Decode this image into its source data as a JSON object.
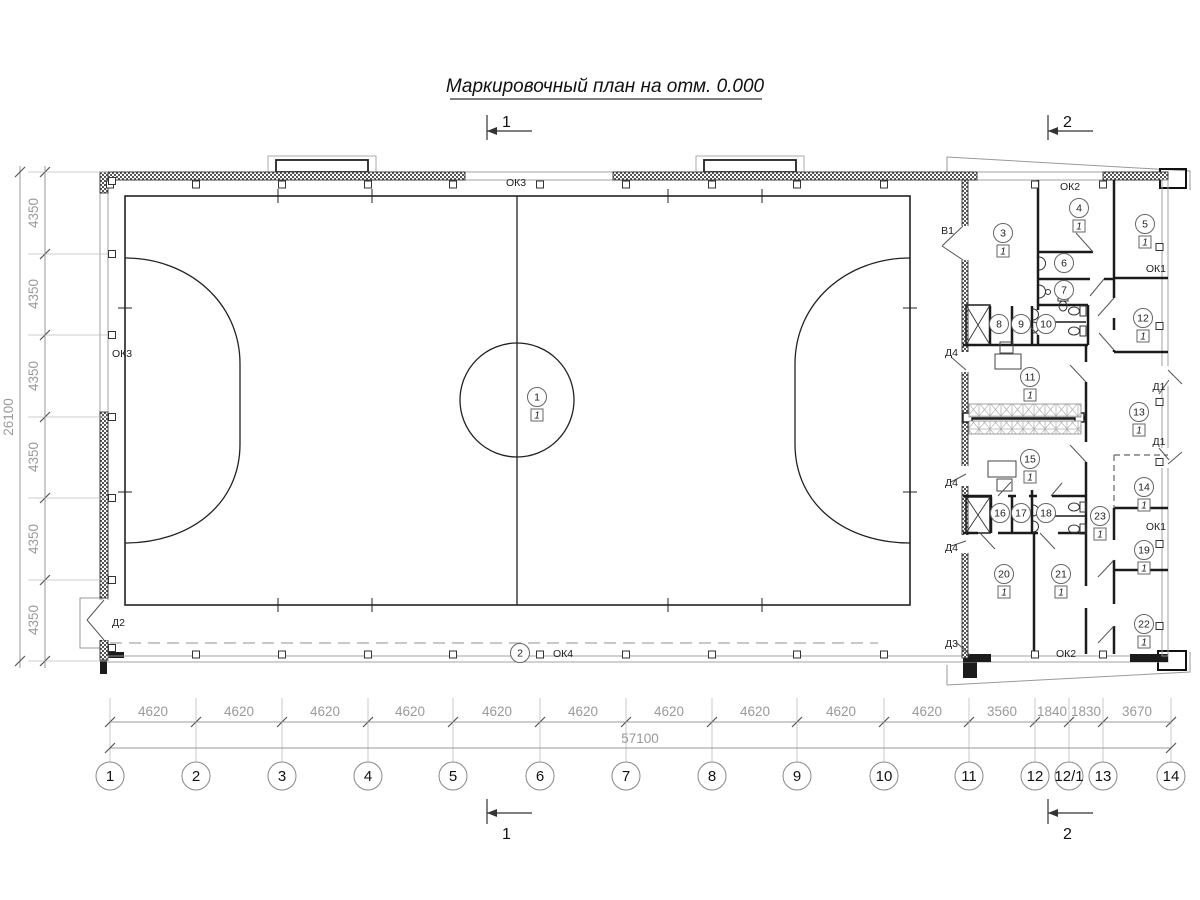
{
  "title": "Маркировочный план на отм. 0.000",
  "section_markers": [
    {
      "label": "1",
      "pos": "top-left"
    },
    {
      "label": "2",
      "pos": "top-right"
    },
    {
      "label": "1",
      "pos": "bottom-left"
    },
    {
      "label": "2",
      "pos": "bottom-right"
    }
  ],
  "grid": {
    "axes": [
      {
        "label": "1",
        "x": 110
      },
      {
        "label": "2",
        "x": 196
      },
      {
        "label": "3",
        "x": 282
      },
      {
        "label": "4",
        "x": 368
      },
      {
        "label": "5",
        "x": 453
      },
      {
        "label": "6",
        "x": 540
      },
      {
        "label": "7",
        "x": 626
      },
      {
        "label": "8",
        "x": 712
      },
      {
        "label": "9",
        "x": 797
      },
      {
        "label": "10",
        "x": 884
      },
      {
        "label": "11",
        "x": 969
      },
      {
        "label": "12",
        "x": 1035
      },
      {
        "label": "12/1",
        "x": 1069
      },
      {
        "label": "13",
        "x": 1103
      },
      {
        "label": "14",
        "x": 1171
      }
    ],
    "dim_segments": [
      {
        "label": "4620",
        "x": 153
      },
      {
        "label": "4620",
        "x": 239
      },
      {
        "label": "4620",
        "x": 325
      },
      {
        "label": "4620",
        "x": 410
      },
      {
        "label": "4620",
        "x": 497
      },
      {
        "label": "4620",
        "x": 583
      },
      {
        "label": "4620",
        "x": 669
      },
      {
        "label": "4620",
        "x": 755
      },
      {
        "label": "4620",
        "x": 841
      },
      {
        "label": "4620",
        "x": 927
      },
      {
        "label": "3560",
        "x": 1002
      },
      {
        "label": "1840",
        "x": 1052
      },
      {
        "label": "1830",
        "x": 1086
      },
      {
        "label": "3670",
        "x": 1137
      }
    ],
    "dim_total": "57100",
    "left_segments": [
      {
        "label": "4350",
        "y": 213
      },
      {
        "label": "4350",
        "y": 294
      },
      {
        "label": "4350",
        "y": 376
      },
      {
        "label": "4350",
        "y": 457
      },
      {
        "label": "4350",
        "y": 539
      },
      {
        "label": "4350",
        "y": 620
      }
    ],
    "left_total": "26100"
  },
  "finish_tag": "1",
  "rooms": [
    {
      "n": "1",
      "x": 537,
      "y": 397,
      "f": true
    },
    {
      "n": "2",
      "x": 520,
      "y": 653,
      "f": false
    },
    {
      "n": "3",
      "x": 1003,
      "y": 233,
      "f": true
    },
    {
      "n": "4",
      "x": 1079,
      "y": 208,
      "f": true
    },
    {
      "n": "5",
      "x": 1145,
      "y": 224,
      "f": true
    },
    {
      "n": "6",
      "x": 1064,
      "y": 263,
      "f": false
    },
    {
      "n": "7",
      "x": 1064,
      "y": 290,
      "f": false
    },
    {
      "n": "8",
      "x": 999,
      "y": 324,
      "f": false
    },
    {
      "n": "9",
      "x": 1021,
      "y": 324,
      "f": false
    },
    {
      "n": "10",
      "x": 1046,
      "y": 324,
      "f": false
    },
    {
      "n": "11",
      "x": 1030,
      "y": 377,
      "f": true
    },
    {
      "n": "12",
      "x": 1143,
      "y": 318,
      "f": true
    },
    {
      "n": "13",
      "x": 1139,
      "y": 412,
      "f": true
    },
    {
      "n": "14",
      "x": 1144,
      "y": 487,
      "f": true
    },
    {
      "n": "15",
      "x": 1030,
      "y": 459,
      "f": true
    },
    {
      "n": "16",
      "x": 1000,
      "y": 513,
      "f": false
    },
    {
      "n": "17",
      "x": 1021,
      "y": 513,
      "f": false
    },
    {
      "n": "18",
      "x": 1046,
      "y": 513,
      "f": false
    },
    {
      "n": "19",
      "x": 1144,
      "y": 550,
      "f": true
    },
    {
      "n": "20",
      "x": 1004,
      "y": 574,
      "f": true
    },
    {
      "n": "21",
      "x": 1061,
      "y": 574,
      "f": true
    },
    {
      "n": "22",
      "x": 1144,
      "y": 624,
      "f": true
    },
    {
      "n": "23",
      "x": 1100,
      "y": 516,
      "f": true
    }
  ],
  "opening_labels": [
    {
      "text": "ОК3",
      "x": 516,
      "y": 186,
      "anchor": "middle"
    },
    {
      "text": "ОК3",
      "x": 112,
      "y": 357,
      "anchor": "start"
    },
    {
      "text": "ОК2",
      "x": 1070,
      "y": 190,
      "anchor": "middle"
    },
    {
      "text": "ОК2",
      "x": 1066,
      "y": 657,
      "anchor": "middle"
    },
    {
      "text": "ОК4",
      "x": 563,
      "y": 657,
      "anchor": "middle"
    },
    {
      "text": "ОК1",
      "x": 1166,
      "y": 272,
      "anchor": "end"
    },
    {
      "text": "ОК1",
      "x": 1166,
      "y": 530,
      "anchor": "end"
    },
    {
      "text": "В1",
      "x": 954,
      "y": 234,
      "anchor": "end"
    },
    {
      "text": "Д4",
      "x": 958,
      "y": 356,
      "anchor": "end"
    },
    {
      "text": "Д4",
      "x": 958,
      "y": 486,
      "anchor": "end"
    },
    {
      "text": "Д4",
      "x": 958,
      "y": 551,
      "anchor": "end"
    },
    {
      "text": "Д2",
      "x": 112,
      "y": 626,
      "anchor": "start"
    },
    {
      "text": "Д3",
      "x": 958,
      "y": 647,
      "anchor": "end"
    },
    {
      "text": "Д1",
      "x": 1159,
      "y": 390,
      "anchor": "middle"
    },
    {
      "text": "Д1",
      "x": 1159,
      "y": 445,
      "anchor": "middle"
    }
  ],
  "colors": {
    "wall": "#1b1b1b",
    "thin_line": "#999999",
    "dim_text": "#9a9a9a",
    "field_line": "#222222"
  }
}
